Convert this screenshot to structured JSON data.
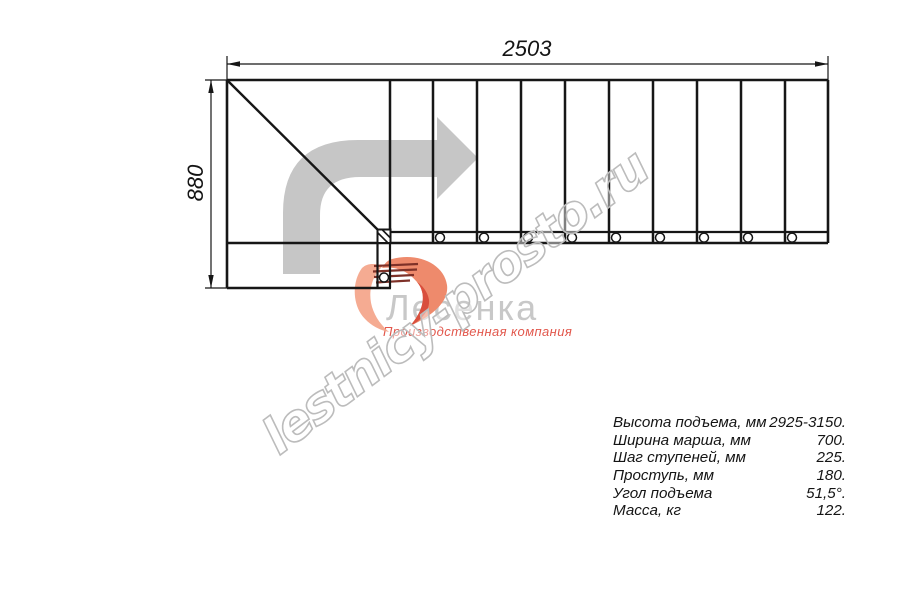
{
  "title": "Stair plan drawing",
  "dimensions": {
    "width": "2503",
    "height": "880"
  },
  "specs": {
    "rows": [
      {
        "label": "Высота подъема, мм",
        "value": "2925-3150."
      },
      {
        "label": "Ширина марша, мм",
        "value": "700."
      },
      {
        "label": "Шаг ступеней, мм",
        "value": "225."
      },
      {
        "label": "Проступь, мм",
        "value": "180."
      },
      {
        "label": "Угол подъема",
        "value": "51,5°."
      },
      {
        "label": "Масса, кг",
        "value": "122."
      }
    ]
  },
  "watermark": {
    "text": "lestnicy-prosto.ru"
  },
  "logo": {
    "name": "Лесенка",
    "tagline": "Производственная компания"
  },
  "colors": {
    "line": "#161616",
    "arrow_gray": "#c6c6c6",
    "watermark_gray": "#bcbcbc",
    "logo_text_gray": "#c8c8c8",
    "logo_red": "#e2574c"
  }
}
